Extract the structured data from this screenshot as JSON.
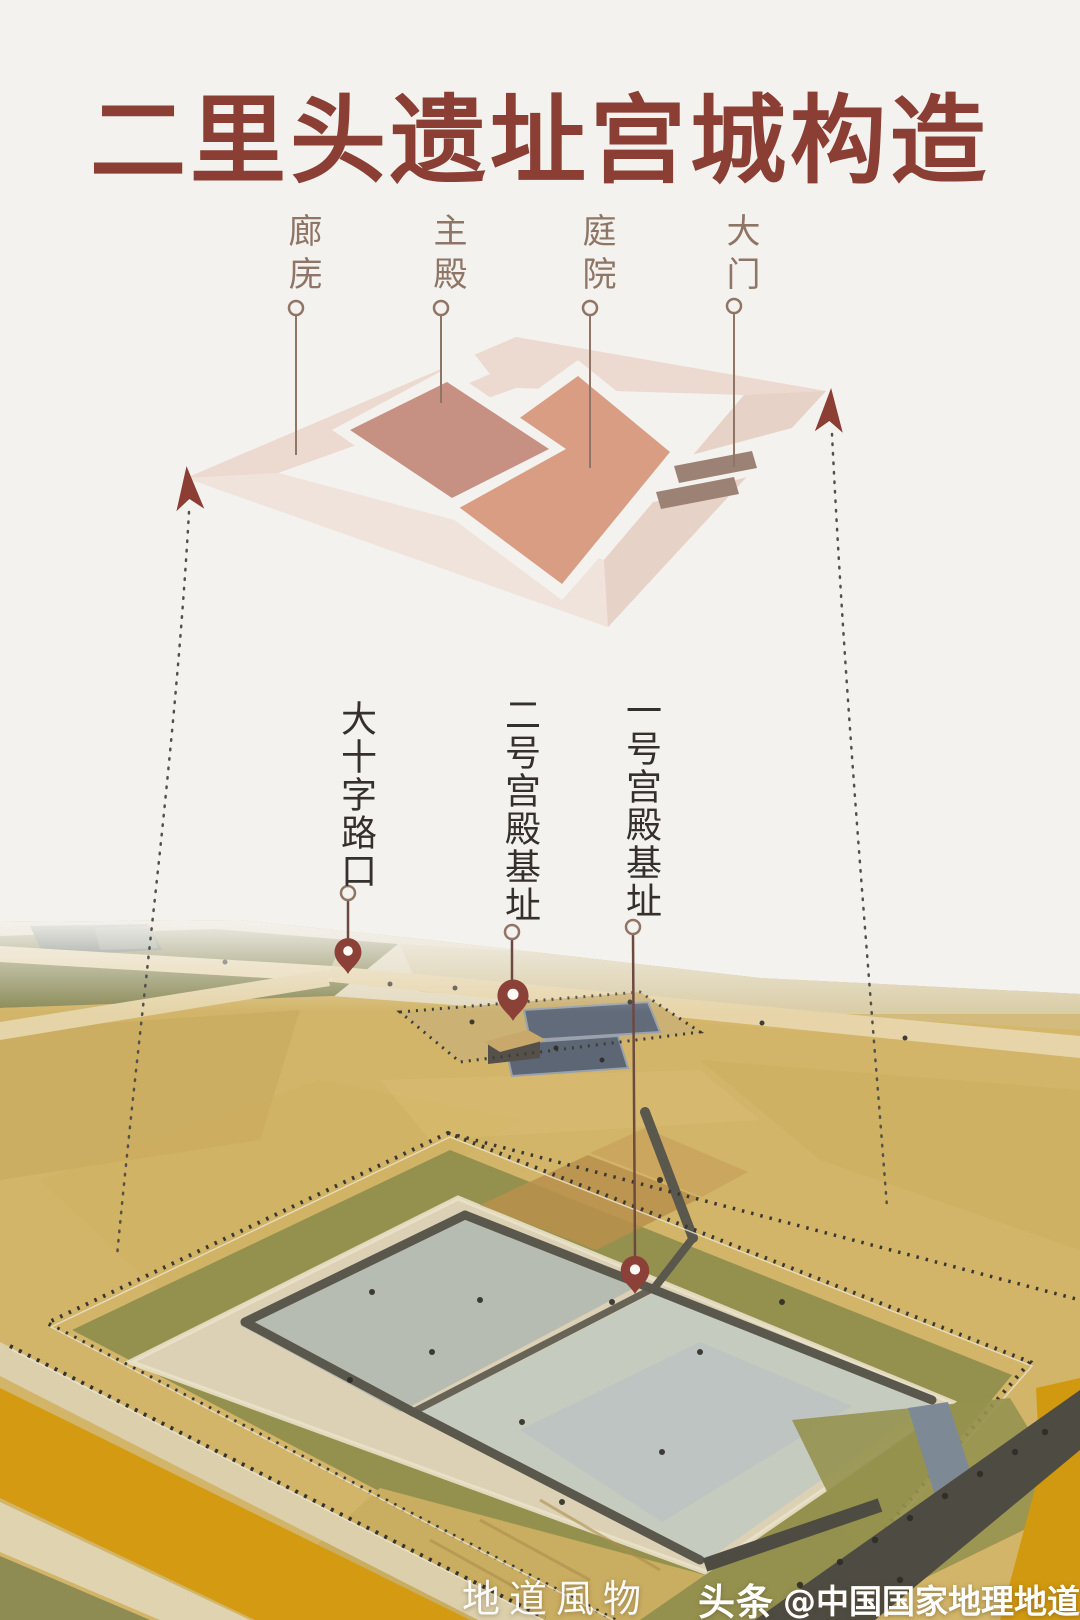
{
  "title": "二里头遗址宫城构造",
  "diagram": {
    "labels": [
      {
        "text": "廊庑"
      },
      {
        "text": "主殿"
      },
      {
        "text": "庭院"
      },
      {
        "text": "大门"
      }
    ],
    "colors": {
      "corridor_ring": "#ecd9cf",
      "main_hall": "#c69183",
      "courtyard": "#d89d83",
      "gate": "#9c8275"
    }
  },
  "site_labels": [
    {
      "text": "大十字路口"
    },
    {
      "text": "二号宫殿基址"
    },
    {
      "text": "一号宫殿基址"
    }
  ],
  "watermark": {
    "brand": "地道風物",
    "platform": "头条",
    "handle": "@中国国家地理地道风物"
  },
  "accent": {
    "title_red": "#8a3e34",
    "pin_red": "#8c4138",
    "label_brown": "#8e7565",
    "label_dark": "#35302b"
  }
}
